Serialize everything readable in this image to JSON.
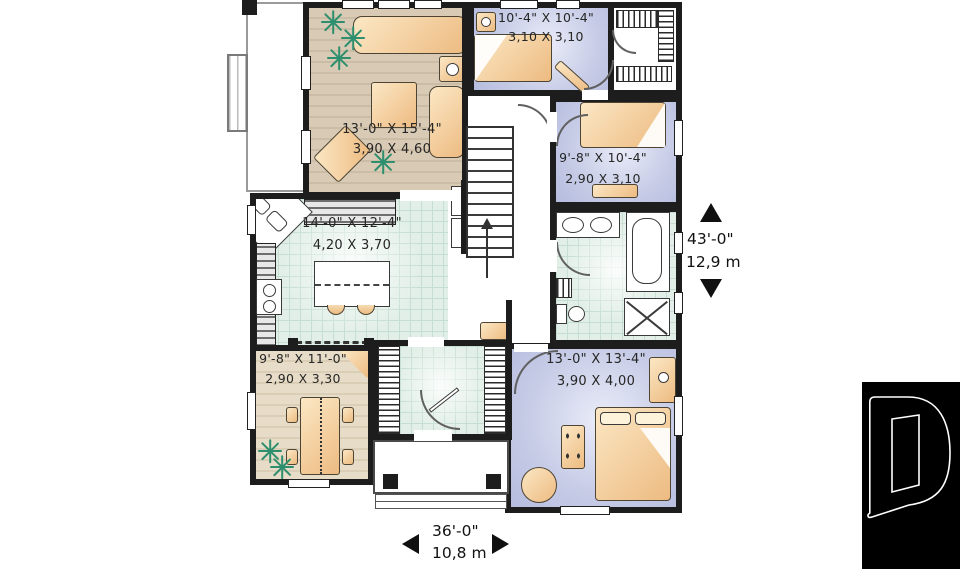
{
  "plan": {
    "rooms": {
      "living": {
        "imperial": "13'-0\" X 15'-4\"",
        "metric": "3,90 X 4,60"
      },
      "kitchen": {
        "imperial": "14'-0\" X 12'-4\"",
        "metric": "4,20 X 3,70"
      },
      "dining": {
        "imperial": "9'-8\" X 11'-0\"",
        "metric": "2,90 X 3,30"
      },
      "bedroom_top_right": {
        "imperial": "10'-4\" X 10'-4\"",
        "metric": "3,10 X 3,10"
      },
      "bedroom_middle_right": {
        "imperial": "9'-8\" X 10'-4\"",
        "metric": "2,90 X 3,10"
      },
      "master_bedroom": {
        "imperial": "13'-0\" X 13'-4\"",
        "metric": "3,90 X 4,00"
      }
    },
    "overall": {
      "depth_imperial": "43'-0\"",
      "depth_metric": "12,9 m",
      "width_imperial": "36'-0\"",
      "width_metric": "10,8 m"
    }
  },
  "logo": {
    "letter": "D"
  },
  "colors": {
    "wall": "#1d1d1d",
    "bedroom_floor": "#c6cbe6",
    "wood_floor": "#d8cab4",
    "tile_floor": "#e2efe8",
    "furniture": "#f0c98f",
    "plant": "#2e8f6e",
    "logo_background": "#000000",
    "logo_stroke": "#ffffff"
  }
}
